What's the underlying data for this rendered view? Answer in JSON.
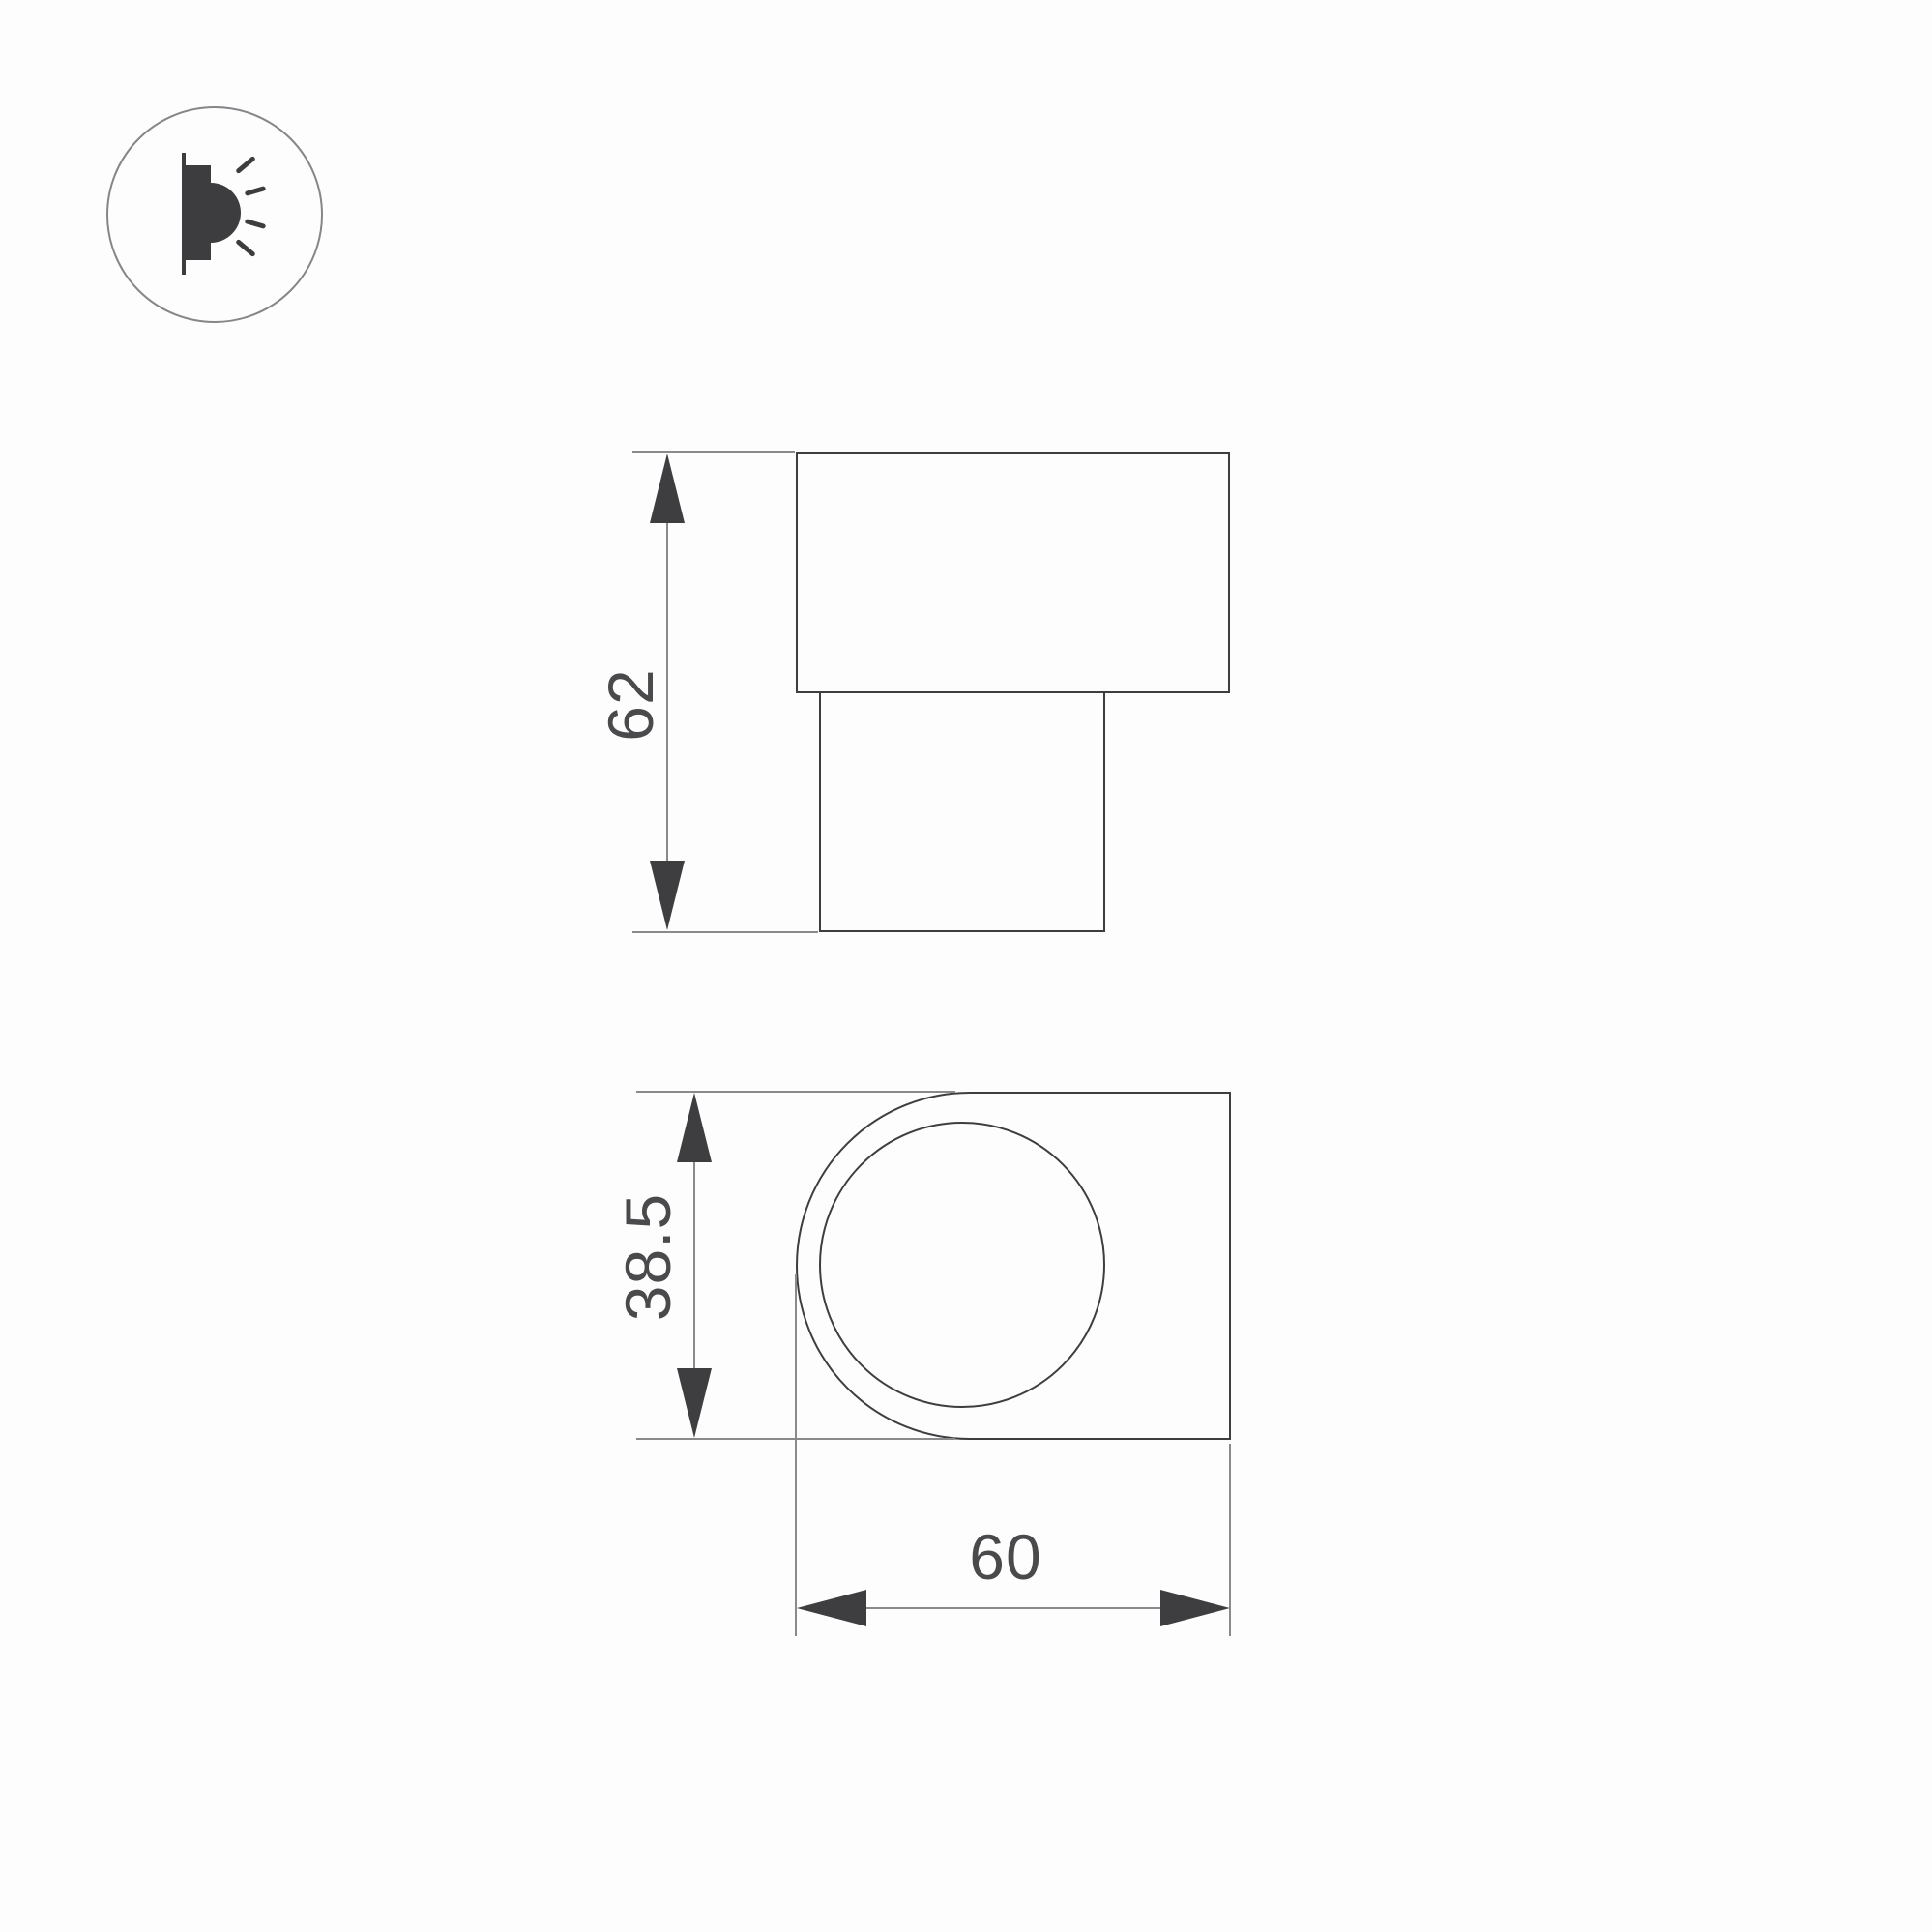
{
  "drawing": {
    "type": "technical-dimension-drawing",
    "subject": "wall-mounted LED luminaire, two orthographic views",
    "views": {
      "front": {
        "height_dimension": "62"
      },
      "side": {
        "height_dimension": "38.5",
        "width_dimension": "60"
      }
    },
    "icon": {
      "name": "wall-lamp-icon",
      "meaning": "surface wall light emitting sideways"
    },
    "colors": {
      "background": "#fdfdfd",
      "outline": "#3e3e41",
      "thin_line": "#8a8a8d",
      "text": "#4a4a4d"
    }
  }
}
